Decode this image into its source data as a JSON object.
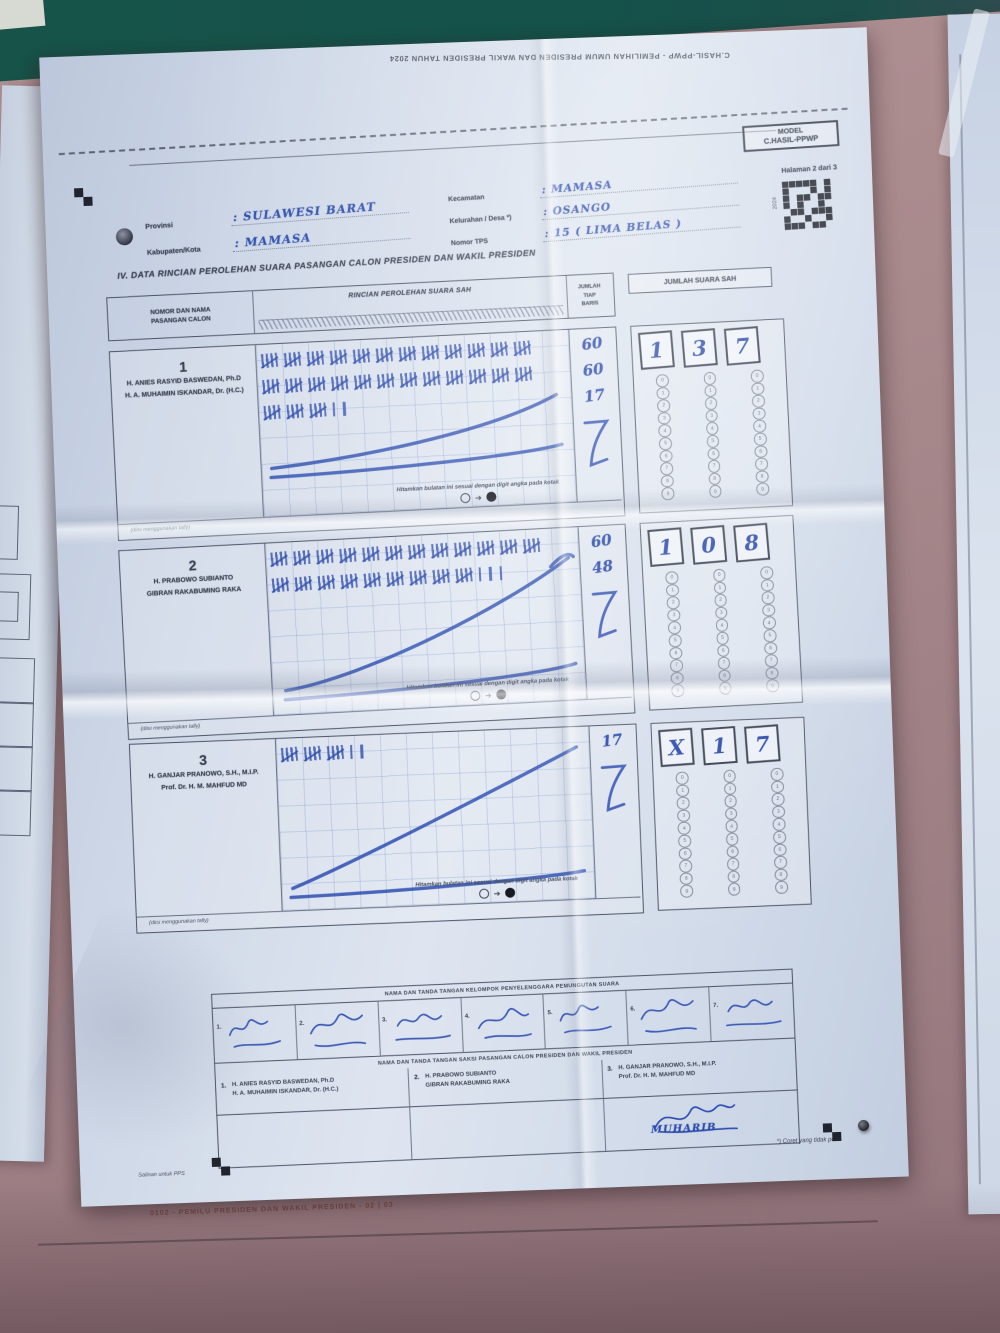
{
  "colors": {
    "wall": "#17544a",
    "board": "#a98b8e",
    "ink": "#2b4bab",
    "print": "#3a4152",
    "paper": "#d4dde9"
  },
  "top_overleaf_text": "C.HASIL-PPWP - PEMILIHAN UMUM PRESIDEN DAN WAKIL PRESIDEN TAHUN 2024",
  "model_box": {
    "line1": "MODEL",
    "line2": "C.HASIL-PPWP",
    "page_note": "Halaman 2 dari 3",
    "qr_side_label": "2024"
  },
  "header_fields": {
    "left": [
      {
        "label": "Provinsi",
        "value": "SULAWESI BARAT"
      },
      {
        "label": "Kabupaten/Kota",
        "value": "MAMASA"
      }
    ],
    "right": [
      {
        "label": "Kecamatan",
        "value": "MAMASA"
      },
      {
        "label": "Kelurahan / Desa *)",
        "value": "OSANGO"
      },
      {
        "label": "Nomor TPS",
        "value": "15   ( LIMA BELAS )"
      }
    ]
  },
  "section_title": "IV.   DATA RINCIAN PEROLEHAN SUARA PASANGAN CALON PRESIDEN DAN WAKIL PRESIDEN",
  "table": {
    "header": {
      "candidates": [
        "NOMOR DAN NAMA",
        "PASANGAN CALON"
      ],
      "tally": "RINCIAN PEROLEHAN SUARA SAH",
      "row_total": [
        "JUMLAH",
        "TIAP",
        "BARIS"
      ],
      "valid_votes": "JUMLAH SUARA SAH"
    },
    "instruction": "Hitamkan bulatan ini sesuai dengan digit angka pada kotak",
    "note": "(diisi menggunakan tally)",
    "bubble_digits": [
      "0",
      "1",
      "2",
      "3",
      "4",
      "5",
      "6",
      "7",
      "8",
      "9"
    ],
    "candidates": [
      {
        "number": "1",
        "name_line1": "H. ANIES RASYID BASWEDAN, Ph.D",
        "name_line2": "H. A. MUHAIMIN ISKANDAR, Dr. (H.C.)",
        "tally_rows": [
          {
            "groups": 12,
            "singles": 0,
            "row_total": "60"
          },
          {
            "groups": 12,
            "singles": 0,
            "row_total": "60"
          },
          {
            "groups": 3,
            "singles": 2,
            "row_total": "17"
          }
        ],
        "total_boxes": [
          "1",
          "3",
          "7"
        ],
        "total_valid_votes": 137
      },
      {
        "number": "2",
        "name_line1": "H. PRABOWO SUBIANTO",
        "name_line2": "GIBRAN RAKABUMING RAKA",
        "tally_rows": [
          {
            "groups": 12,
            "singles": 0,
            "row_total": "60"
          },
          {
            "groups": 9,
            "singles": 3,
            "row_total": "48"
          }
        ],
        "total_boxes": [
          "1",
          "0",
          "8"
        ],
        "total_valid_votes": 108
      },
      {
        "number": "3",
        "name_line1": "H. GANJAR PRANOWO, S.H., M.I.P.",
        "name_line2": "Prof. Dr. H. M. MAHFUD MD",
        "tally_rows": [
          {
            "groups": 3,
            "singles": 2,
            "row_total": "17"
          }
        ],
        "total_boxes": [
          "X",
          "1",
          "7"
        ],
        "total_valid_votes": 17
      }
    ]
  },
  "signatures": {
    "kpps_header": "NAMA DAN TANDA TANGAN KELOMPOK PENYELENGGARA PEMUNGUTAN SUARA",
    "kpps_numbers": [
      "1.",
      "2.",
      "3.",
      "4.",
      "5.",
      "6.",
      "7."
    ],
    "saksi_header": "NAMA DAN TANDA TANGAN SAKSI PASANGAN CALON PRESIDEN DAN WAKIL PRESIDEN",
    "saksi_cells": [
      {
        "number": "1.",
        "line1": "H. ANIES RASYID BASWEDAN, Ph.D",
        "line2": "H. A. MUHAIMIN ISKANDAR, Dr. (H.C.)"
      },
      {
        "number": "2.",
        "line1": "H. PRABOWO SUBIANTO",
        "line2": "GIBRAN RAKABUMING RAKA"
      },
      {
        "number": "3.",
        "line1": "H. GANJAR PRANOWO, S.H., M.I.P.",
        "line2": "Prof. Dr. H. M. MAHFUD MD"
      }
    ],
    "saksi_signature_name": "MUHARIB"
  },
  "footers": {
    "left": "Salinan untuk PPS",
    "right": "*) Coret yang tidak perlu",
    "board_bottom": "0102 - PEMILU PRESIDEN DAN WAKIL PRESIDEN - 02 | 03"
  }
}
